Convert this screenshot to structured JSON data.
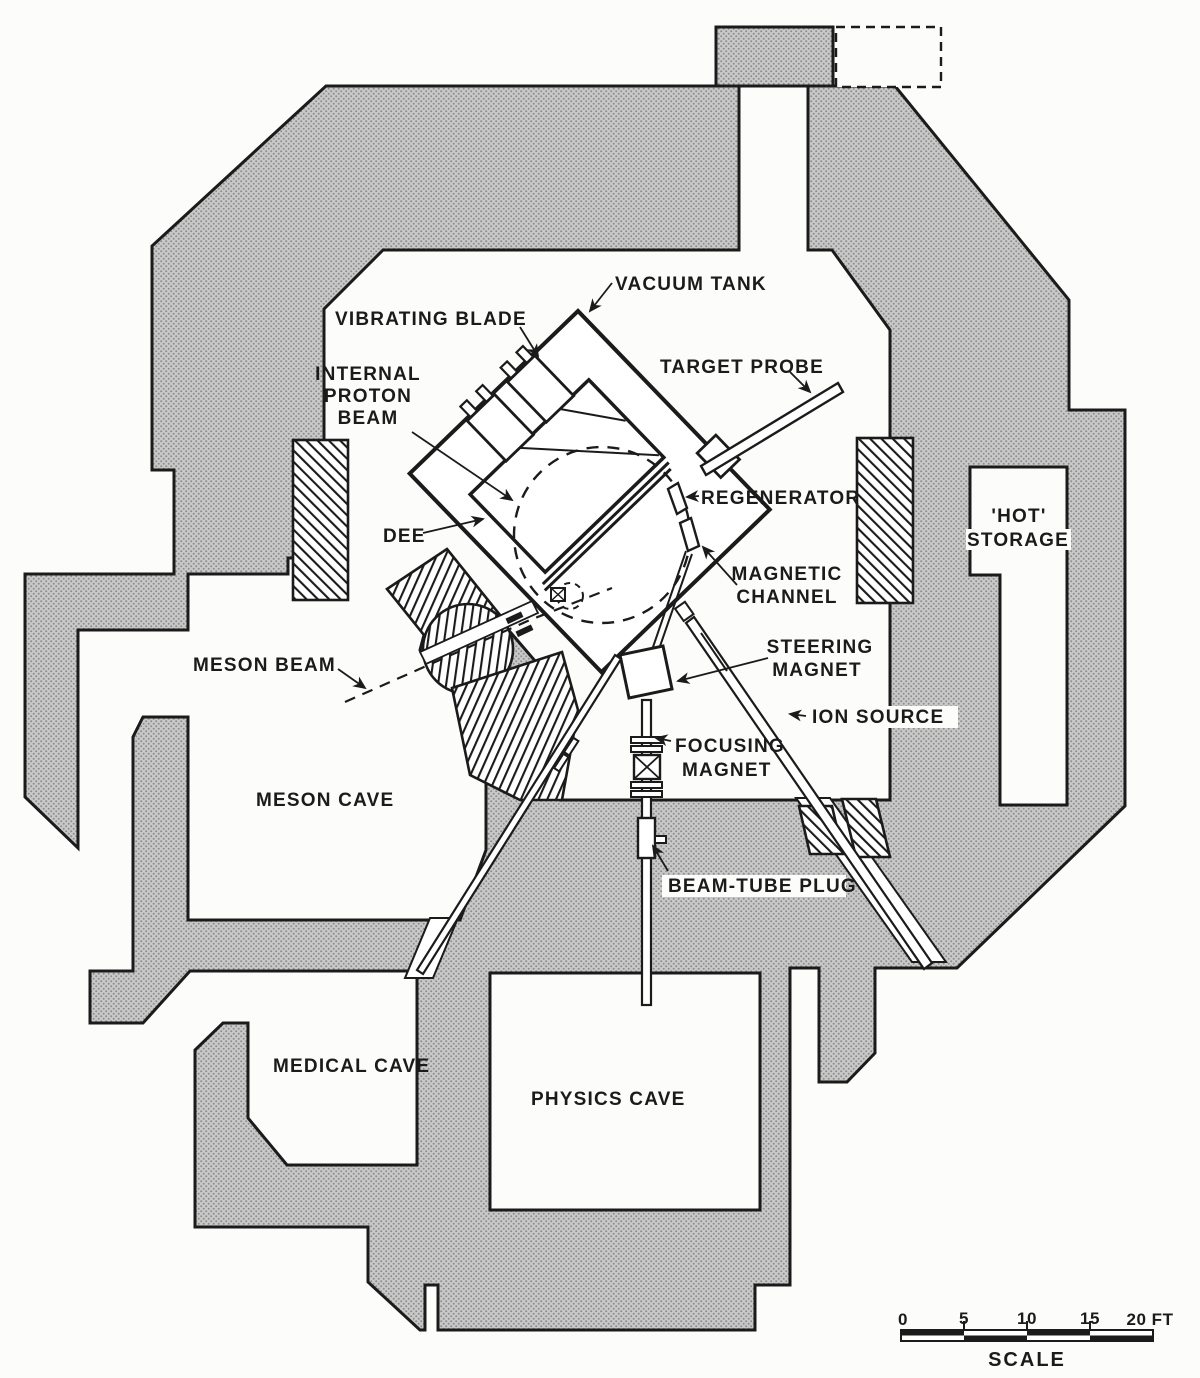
{
  "diagram_title": "Cyclotron facility shielding floor plan",
  "labels": {
    "vacuum_tank": "VACUUM TANK",
    "vibrating_blade": "VIBRATING BLADE",
    "internal_proton_beam_line1": "INTERNAL",
    "internal_proton_beam_line2": "PROTON",
    "internal_proton_beam_line3": "BEAM",
    "target_probe": "TARGET PROBE",
    "regenerator": "REGENERATOR",
    "magnetic_channel_line1": "MAGNETIC",
    "magnetic_channel_line2": "CHANNEL",
    "dee": "DEE",
    "steering_magnet_line1": "STEERING",
    "steering_magnet_line2": "MAGNET",
    "ion_source": "ION SOURCE",
    "focusing_magnet_line1": "FOCUSING",
    "focusing_magnet_line2": "MAGNET",
    "beam_tube_plug": "BEAM-TUBE PLUG",
    "meson_beam": "MESON BEAM",
    "meson_cave": "MESON CAVE",
    "hot_storage_line1": "'HOT'",
    "hot_storage_line2": "STORAGE",
    "medical_cave": "MEDICAL CAVE",
    "physics_cave": "PHYSICS CAVE"
  },
  "scale_bar": {
    "ticks": [
      "0",
      "5",
      "10",
      "15",
      "20 FT"
    ],
    "caption": "SCALE"
  },
  "colors": {
    "ink": "#1b1b1b",
    "shielding_fill": "#c9c9c9",
    "shielding_dot": "#8d8d8d",
    "paper": "#fcfcfa"
  }
}
